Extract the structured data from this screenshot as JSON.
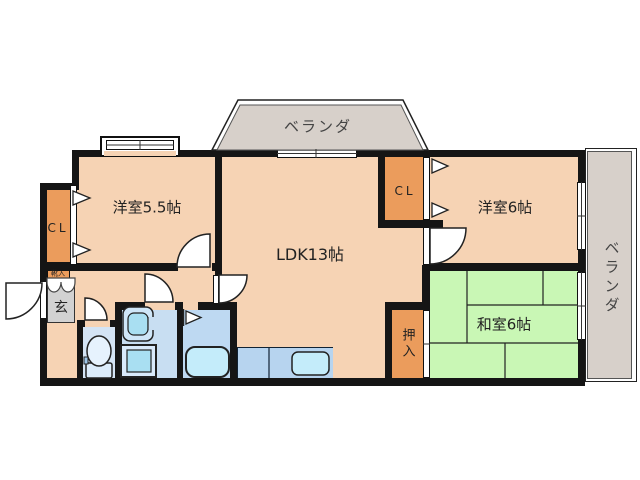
{
  "labels": {
    "veranda_top": "ベランダ",
    "veranda_right": "ベランダ",
    "western_room_5_5": "洋室5.5帖",
    "ldk": "LDK13帖",
    "western_room_6": "洋室6帖",
    "japanese_room_6": "和室6帖",
    "closet_left": "CL",
    "closet_right": "CL",
    "oshiire": "押入",
    "genkan": "玄",
    "shoe_cabinet": "靴入"
  },
  "colors": {
    "wall": "#151515",
    "room_floor": "#f6d3b4",
    "closet": "#eb9c5c",
    "tatami": "#c9f7b5",
    "veranda": "#d7d0ca",
    "genkan_floor": "#d2d2d2",
    "toilet_room": "#d4e4f5",
    "washroom": "#c8def2",
    "bathroom": "#bed9f2",
    "kitchen_counter": "#b7d4ef",
    "fixture_light": "#c4ecfa",
    "fixture_mid": "#a9dff2"
  }
}
